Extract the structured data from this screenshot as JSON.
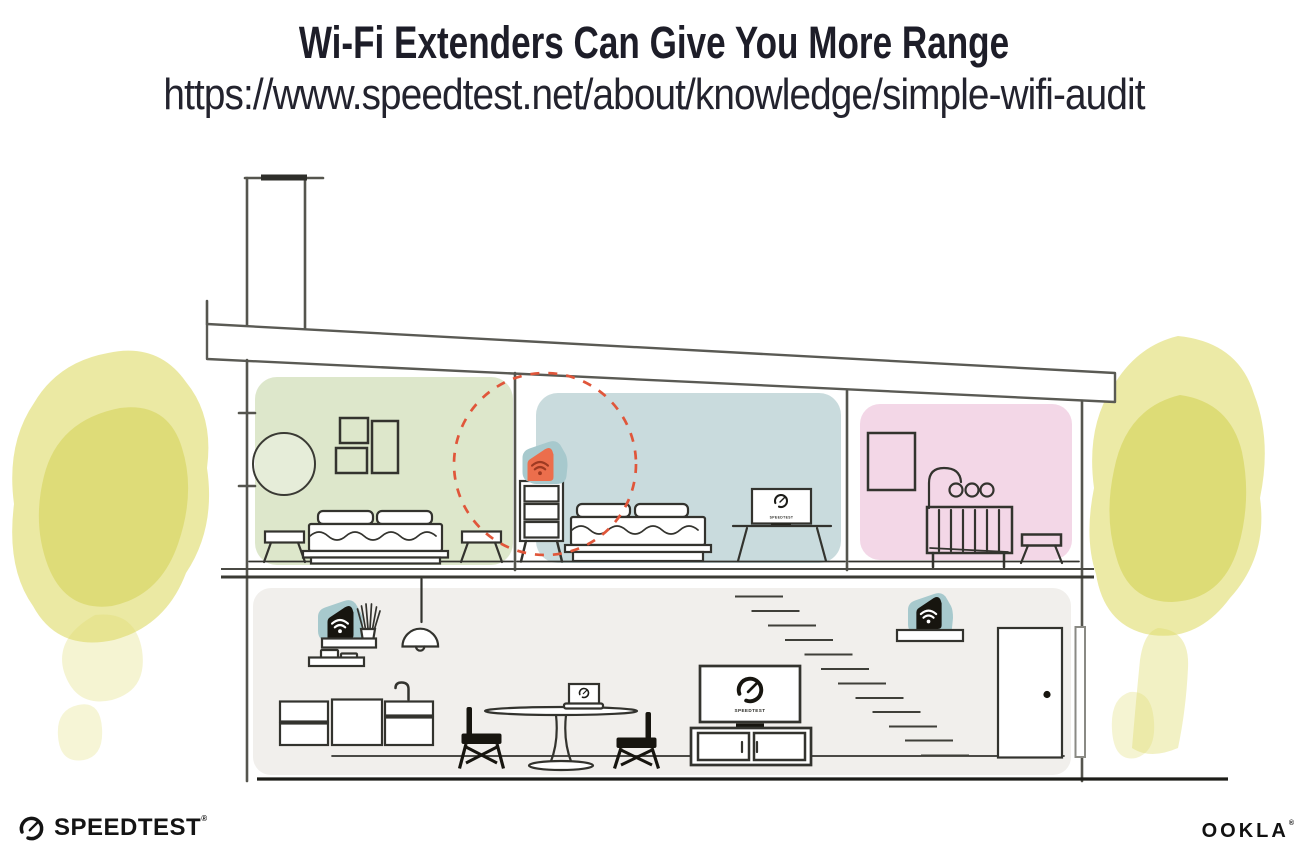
{
  "header": {
    "title": "Wi-Fi Extenders Can Give You More Range",
    "subtitle_url": "https://www.speedtest.net/about/knowledge/simple-wifi-audit"
  },
  "footer": {
    "speedtest_logo_text": "SPEEDTEST",
    "speedtest_registered_mark": "®",
    "ookla_logo_text": "OOKLA",
    "ookla_registered_mark": "®"
  },
  "illustration": {
    "tv_screen_brand_label": "SPEEDTEST",
    "colors": {
      "extender_highlight_orange": "#ec6e4c",
      "extender_wifi_dark_red": "#9e3a22",
      "extender_device_black": "#17150f",
      "extender_glow_teal": "#a7c9cd",
      "range_circle_dashed_red": "#e0563a",
      "bedroom_green": "#dde7cb",
      "bedroom_blue": "#c9dbdd",
      "nursery_pink": "#f3d7e7",
      "downstairs_gray": "#f1efec",
      "tree_yellow": "#dfdc6b",
      "outline_dark": "#33332e"
    }
  }
}
